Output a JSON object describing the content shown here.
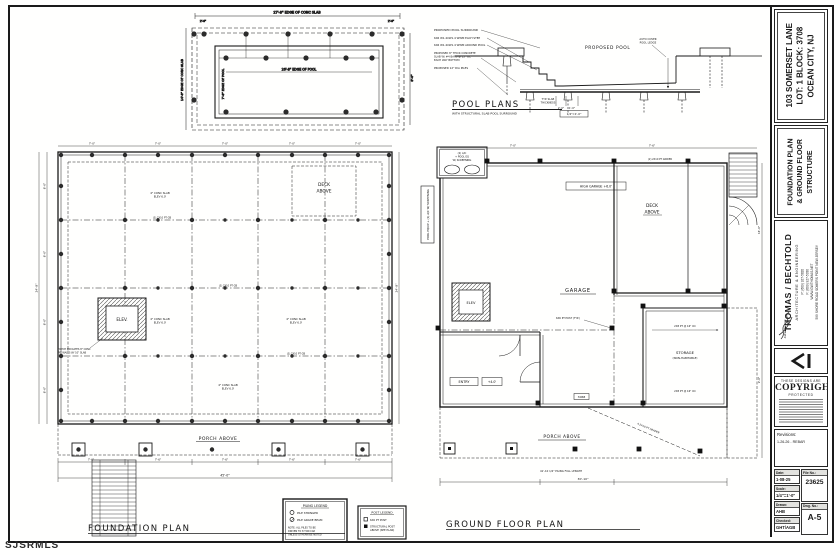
{
  "colors": {
    "ink": "#1a1a1a",
    "paper": "#ffffff",
    "dash": "#444444"
  },
  "watermark": "SJSRMLS",
  "titleblock": {
    "address": [
      "103 SOMERSET LANE",
      "LOT: 1   BLOCK: 3708",
      "OCEAN CITY, NJ"
    ],
    "sheet_title": [
      "FOUNDATION PLAN",
      "& GROUND FLOOR",
      "STRUCTURE"
    ],
    "firm": {
      "name": "THOMAS / BECHTOLD",
      "tagline": "ARCHITECTURE & ENGINEERING",
      "phone": "P: (609) 927-5820",
      "fax": "F: (609) 927-5330",
      "web": "WWW.GWTHOMAS.NET",
      "address": "599 SHORE ROAD   SOMERS POINT   NEW JERSEY",
      "signature": "Andrew Bechtold"
    },
    "copyright": {
      "line1": "THESE DESIGNS ARE",
      "word": "COPYRIGHT",
      "line2": "PROTECTED"
    },
    "revisions": {
      "label": "Revisions:",
      "entry": "1-26-26  -  REBAR"
    },
    "fields": {
      "date_label": "Date:",
      "date": "1-08-25",
      "scale_label": "Scale:",
      "scale": "1/4\"=1'-0\"",
      "drawn_label": "Drawn:",
      "drawn": "AHB",
      "checked_label": "Checked:",
      "checked": "GHT/AGB",
      "file_label": "File No.:",
      "file": "23625",
      "dwg_label": "Dwg. No.:",
      "dwg": "A-5"
    }
  },
  "pool_plan": {
    "dim_slab_top": "27'-8\" EDGE OF CONC SLAB",
    "dim_pool_top": "26'-8\" EDGE OF POOL",
    "dim_slab_left": "14'-8\" EDGE OF CONC SLAB",
    "dim_pool_left": "7'-8\" EDGE OF POOL"
  },
  "pool_section": {
    "title": "POOL PLANS",
    "subtitle": "WITH STRUCTURAL SLAB POOL SURROUND",
    "scale": "1/4\"=1'-0\"",
    "labels": {
      "surround": "PROPOSED POOL SURROUND",
      "mesh_step": "6X6 W1.4XW1.4 WWM EACH STEP",
      "mesh_pool": "6X6 W1.4XW1.4 WWM AROUND POOL",
      "slab1": "PROPOSED 8\" THICK CONCRETE",
      "slab2": "SLAB W/ #4 BARS @ 12\" OC",
      "slab3": "EACH WAY BOTTOM",
      "piles": "PROPOSED 12\" DIA PILES",
      "pool": "PROPOSED POOL",
      "ledge1": "AUTO COVER",
      "ledge2": "POOL LEDGE",
      "typ1": "TYP. SLAB",
      "typ2": "THICKNESS",
      "dim_a": "2'-0\"",
      "dim_b": "1'-0\""
    }
  },
  "foundation": {
    "title": "FOUNDATION PLAN",
    "elev_label": "ELEV.",
    "elev_note1": "HATCH INDICATES 8\" CONC",
    "elev_note2": "PIT WALLS W/ 10\" SLAB",
    "deck1": "DECK",
    "deck2": "ABOVE",
    "porch": "PORCH ABOVE",
    "slab1": "4\" CONC SLAB",
    "slab2": "ELEV 6.0'",
    "beam": "(3) 2X10 PT GB"
  },
  "groundfloor": {
    "title": "GROUND FLOOR PLAN",
    "high_garage": "HIGH GARAGE +6.0'",
    "garage": "GARAGE",
    "deck1": "DECK",
    "deck2": "ABOVE",
    "storage1": "STORAGE",
    "storage2": "(NON-HABITABLE)",
    "entry": "ENTRY",
    "entry_elev": "+4.0'",
    "porch": "PORCH ABOVE",
    "elev": "ELEV",
    "ac1": "(2) A/C",
    "ac2": "+ POOL EQ",
    "ac3": "W/ SCREENING",
    "pool_equip_side": "POOL EQUIP + (2) A/C W/ SCREENING",
    "piling_note": "41'-10 1/2\" PILING FULL LENGTH",
    "header_callout": "4-2X10 PT HEADER",
    "joist_callout": "2X8 PT @ 16\" OC",
    "post_callout": "6X6 PT POST (TYP.)",
    "beam_top": "(2) 2X10 PT GIRDER",
    "door_tag": "3068"
  },
  "legends": {
    "piling": {
      "title": "PILING LEGEND",
      "item1": "PILE STRINGER",
      "item2": "PILE GRADE BEAM",
      "note1": "NOTE: ALL PILES TO BE",
      "note2": "DRIVEN TO 8 TON CAP.",
      "note3": "UNLESS OTHERWISE NOTED"
    },
    "post": {
      "title": "POST LEGEND",
      "item1": "6X6 PT POST",
      "item2a": "STRUCTURAL POST",
      "item2b": "ABOVE (SEE PLAN)"
    }
  },
  "dims": {
    "d70": "7'-0\"",
    "d80": "8'-0\"",
    "d76": "7'-6\"",
    "d45": "45'-0\"",
    "d248": "24'-8\"",
    "d16": "16'-0\"",
    "d9": "9'-0\"",
    "d3010": "30'-10\"",
    "d26": "2'-6\""
  }
}
